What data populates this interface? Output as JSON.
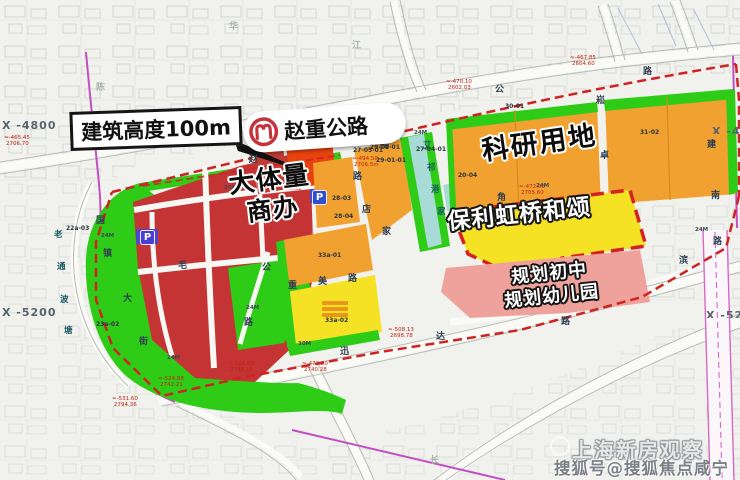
{
  "map": {
    "callouts": {
      "building_height": "建筑高度100m",
      "highway": "赵重公路",
      "commercial_line1": "大体量",
      "commercial_line2": "商办",
      "research": "科研用地",
      "poly_project": "保利虹桥和颂",
      "school_line1": "规划初中",
      "school_line2": "规划幼儿园"
    },
    "coordinates": {
      "left_top": "X -4800",
      "left_bottom": "X -5200",
      "right_top": "X -48",
      "right_bottom": "X -520"
    },
    "watermark": {
      "line1": "上海新房观察",
      "line2": "搜狐号@搜狐焦点咸宁站"
    },
    "icons": {
      "parking_letter": "P",
      "metro_logo": "shanghai-metro-logo"
    },
    "colors": {
      "red_parcel": "#c43434",
      "highlight_red": "#e8430e",
      "orange_parcel": "#f0a130",
      "yellow_parcel": "#f6e224",
      "green_belt": "#2fcc17",
      "river_cyan": "#a8dbd6",
      "school_pink": "#efa29b",
      "metro_gray": "#9fa9bb",
      "boundary_dashed_red": "#cf2222",
      "boundary_purple": "#c24fc2",
      "metro_logo_red": "#c5343c",
      "parking_blue": "#2d4fd0"
    },
    "small_labels": [
      {
        "t": "公",
        "x": 495,
        "y": 86,
        "k": "road"
      },
      {
        "t": "路",
        "x": 643,
        "y": 68,
        "k": "road"
      },
      {
        "t": "崧",
        "x": 596,
        "y": 97,
        "k": "road"
      },
      {
        "t": "卓",
        "x": 600,
        "y": 152,
        "k": "road"
      },
      {
        "t": "建",
        "x": 707,
        "y": 141,
        "k": "road"
      },
      {
        "t": "南",
        "x": 711,
        "y": 192,
        "k": "road"
      },
      {
        "t": "路",
        "x": 713,
        "y": 238,
        "k": "road"
      },
      {
        "t": "滨",
        "x": 679,
        "y": 257,
        "k": "road"
      },
      {
        "t": "店",
        "x": 362,
        "y": 206,
        "k": "road"
      },
      {
        "t": "家",
        "x": 382,
        "y": 228,
        "k": "road"
      },
      {
        "t": "角",
        "x": 497,
        "y": 194,
        "k": "road"
      },
      {
        "t": "福",
        "x": 380,
        "y": 141,
        "k": "road"
      },
      {
        "t": "路",
        "x": 353,
        "y": 173,
        "k": "road"
      },
      {
        "t": "国",
        "x": 96,
        "y": 217,
        "k": "road"
      },
      {
        "t": "镇",
        "x": 103,
        "y": 250,
        "k": "road"
      },
      {
        "t": "大",
        "x": 123,
        "y": 295,
        "k": "road"
      },
      {
        "t": "街",
        "x": 139,
        "y": 338,
        "k": "road"
      },
      {
        "t": "毛",
        "x": 178,
        "y": 262,
        "k": "road"
      },
      {
        "t": "公",
        "x": 262,
        "y": 264,
        "k": "road"
      },
      {
        "t": "路",
        "x": 244,
        "y": 319,
        "k": "road"
      },
      {
        "t": "重",
        "x": 288,
        "y": 282,
        "k": "road"
      },
      {
        "t": "美",
        "x": 318,
        "y": 278,
        "k": "road"
      },
      {
        "t": "路",
        "x": 348,
        "y": 275,
        "k": "road"
      },
      {
        "t": "迅",
        "x": 340,
        "y": 348,
        "k": "road"
      },
      {
        "t": "达",
        "x": 436,
        "y": 333,
        "k": "road"
      },
      {
        "t": "路",
        "x": 561,
        "y": 318,
        "k": "road"
      },
      {
        "t": "赵",
        "x": 249,
        "y": 156,
        "k": "road"
      },
      {
        "t": "老",
        "x": 54,
        "y": 231,
        "k": "river"
      },
      {
        "t": "通",
        "x": 57,
        "y": 263,
        "k": "river"
      },
      {
        "t": "波",
        "x": 60,
        "y": 296,
        "k": "river"
      },
      {
        "t": "塘",
        "x": 64,
        "y": 327,
        "k": "river"
      },
      {
        "t": "艾",
        "x": 423,
        "y": 142,
        "k": "river"
      },
      {
        "t": "祁",
        "x": 427,
        "y": 164,
        "k": "river"
      },
      {
        "t": "港",
        "x": 431,
        "y": 186,
        "k": "river"
      },
      {
        "t": "家",
        "x": 437,
        "y": 208,
        "k": "river"
      },
      {
        "t": "陈",
        "x": 96,
        "y": 84,
        "k": "faint"
      },
      {
        "t": "华",
        "x": 229,
        "y": 23,
        "k": "faint"
      },
      {
        "t": "江",
        "x": 352,
        "y": 42,
        "k": "faint"
      },
      {
        "t": "长",
        "x": 430,
        "y": 457,
        "k": "faint"
      },
      {
        "t": "27-05-01",
        "x": 353,
        "y": 148,
        "k": "code"
      },
      {
        "t": "30-01",
        "x": 505,
        "y": 104,
        "k": "code"
      },
      {
        "t": "31-02",
        "x": 640,
        "y": 130,
        "k": "code"
      },
      {
        "t": "20-04",
        "x": 458,
        "y": 173,
        "k": "code"
      },
      {
        "t": "28-03",
        "x": 332,
        "y": 196,
        "k": "code"
      },
      {
        "t": "28-04",
        "x": 334,
        "y": 214,
        "k": "code"
      },
      {
        "t": "33a-01",
        "x": 318,
        "y": 253,
        "k": "code"
      },
      {
        "t": "33a-02",
        "x": 325,
        "y": 318,
        "k": "code"
      },
      {
        "t": "29-02-01",
        "x": 370,
        "y": 145,
        "k": "code"
      },
      {
        "t": "29-01-01",
        "x": 376,
        "y": 158,
        "k": "code"
      },
      {
        "t": "27-04-01",
        "x": 416,
        "y": 147,
        "k": "code"
      },
      {
        "t": "22a-03",
        "x": 66,
        "y": 226,
        "k": "code"
      },
      {
        "t": "23a-02",
        "x": 96,
        "y": 322,
        "k": "code"
      },
      {
        "t": "≈-467.70",
        "x": 134,
        "y": 122,
        "k": "mark"
      },
      {
        "t": "2705.58",
        "x": 136,
        "y": 128,
        "k": "mark"
      },
      {
        "t": "≈-465.45",
        "x": 4,
        "y": 136,
        "k": "mark"
      },
      {
        "t": "2706.70",
        "x": 6,
        "y": 142,
        "k": "mark"
      },
      {
        "t": "≈-470.10",
        "x": 446,
        "y": 80,
        "k": "mark"
      },
      {
        "t": "2602.03",
        "x": 448,
        "y": 86,
        "k": "mark"
      },
      {
        "t": "≈-467.85",
        "x": 570,
        "y": 56,
        "k": "mark"
      },
      {
        "t": "2604.60",
        "x": 572,
        "y": 62,
        "k": "mark"
      },
      {
        "t": "≈-494.50",
        "x": 352,
        "y": 157,
        "k": "mark"
      },
      {
        "t": "2706.5m",
        "x": 354,
        "y": 163,
        "k": "mark"
      },
      {
        "t": "≈-459.35",
        "x": 277,
        "y": 181,
        "k": "mark"
      },
      {
        "t": "2706.52",
        "x": 279,
        "y": 187,
        "k": "mark"
      },
      {
        "t": "≈-524.88",
        "x": 158,
        "y": 377,
        "k": "mark"
      },
      {
        "t": "2742.21",
        "x": 160,
        "y": 383,
        "k": "mark"
      },
      {
        "t": "≈-531.60",
        "x": 112,
        "y": 397,
        "k": "mark"
      },
      {
        "t": "2794.36",
        "x": 114,
        "y": 403,
        "k": "mark"
      },
      {
        "t": "≈-528.03",
        "x": 228,
        "y": 362,
        "k": "mark"
      },
      {
        "t": "2738.10",
        "x": 230,
        "y": 368,
        "k": "mark"
      },
      {
        "t": "≈-473.20",
        "x": 302,
        "y": 362,
        "k": "mark"
      },
      {
        "t": "2740.28",
        "x": 304,
        "y": 368,
        "k": "mark"
      },
      {
        "t": "≈-508.13",
        "x": 388,
        "y": 328,
        "k": "mark"
      },
      {
        "t": "2698.78",
        "x": 390,
        "y": 334,
        "k": "mark"
      },
      {
        "t": "≈-472.00",
        "x": 519,
        "y": 185,
        "k": "mark"
      },
      {
        "t": "2705.60",
        "x": 521,
        "y": 191,
        "k": "mark"
      },
      {
        "t": "24M",
        "x": 101,
        "y": 234,
        "k": "wid"
      },
      {
        "t": "24M",
        "x": 167,
        "y": 356,
        "k": "wid"
      },
      {
        "t": "24M",
        "x": 246,
        "y": 306,
        "k": "wid"
      },
      {
        "t": "24M",
        "x": 414,
        "y": 131,
        "k": "wid"
      },
      {
        "t": "24M",
        "x": 536,
        "y": 184,
        "k": "wid"
      },
      {
        "t": "24M",
        "x": 695,
        "y": 228,
        "k": "wid"
      },
      {
        "t": "30M",
        "x": 298,
        "y": 342,
        "k": "wid"
      },
      {
        "t": "24M",
        "x": 224,
        "y": 186,
        "k": "wid"
      }
    ]
  }
}
